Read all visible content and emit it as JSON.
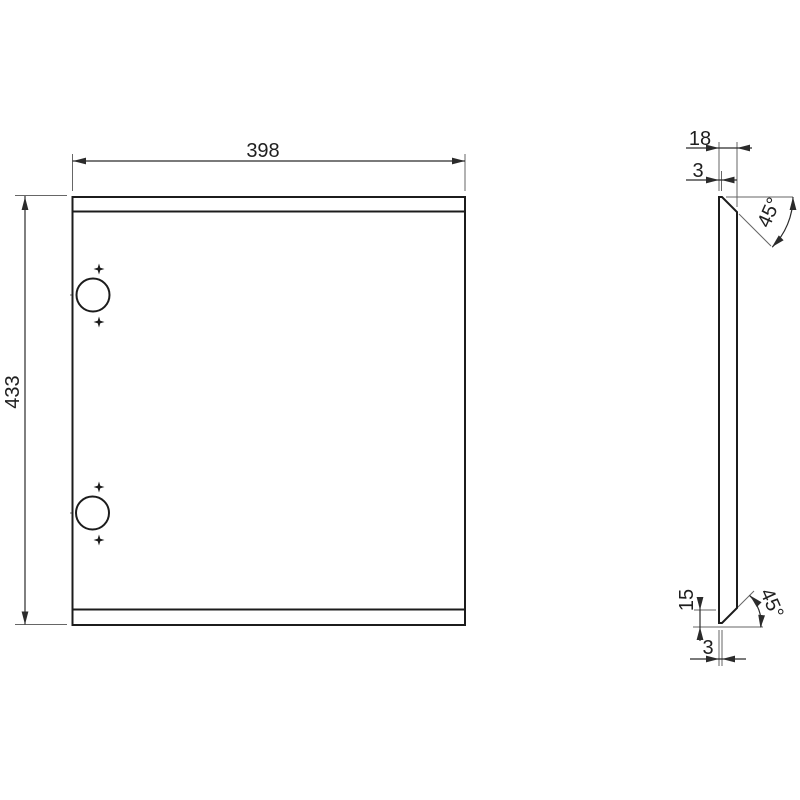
{
  "drawing": {
    "title": "panel-technical-drawing",
    "views": {
      "front": {
        "name": "front-view",
        "width_label": "398",
        "height_label": "433",
        "hole_count": 2
      },
      "side": {
        "name": "side-view",
        "depth_label": "18",
        "top_tip_thickness_label": "3",
        "top_chamfer_angle_label": "45°",
        "bottom_chamfer_height_label": "15",
        "bottom_tip_thickness_label": "3",
        "bottom_chamfer_angle_label": "45°"
      }
    }
  },
  "colors": {
    "background": "#ffffff",
    "object_line": "#1c1c1c",
    "dimension_line": "#2b2b2b",
    "extension_line": "#666666",
    "text": "#1f1f1f"
  },
  "labels": [
    {
      "name": "dim-label-width",
      "text": "398",
      "x": 263,
      "y": 157,
      "rot": 0
    },
    {
      "name": "dim-label-height",
      "text": "433",
      "x": 19,
      "y": 392,
      "rot": -90
    },
    {
      "name": "dim-label-depth",
      "text": "18",
      "x": 700,
      "y": 145,
      "rot": 0
    },
    {
      "name": "dim-label-top-thickness",
      "text": "3",
      "x": 698,
      "y": 177,
      "rot": 0
    },
    {
      "name": "dim-label-top-angle",
      "text": "45°",
      "x": 775,
      "y": 215,
      "rot": -66
    },
    {
      "name": "dim-label-chamfer-height",
      "text": "15",
      "x": 693,
      "y": 600,
      "rot": -90
    },
    {
      "name": "dim-label-bottom-angle",
      "text": "45°",
      "x": 766,
      "y": 606,
      "rot": 66
    },
    {
      "name": "dim-label-bottom-thickness",
      "text": "3",
      "x": 708,
      "y": 654,
      "rot": 0
    }
  ],
  "geom": {
    "object_paths": [
      {
        "name": "panel-outline",
        "d": "M72.5,197 H465 V625 H72.5 Z",
        "fill": true
      },
      {
        "name": "panel-top-fold-line",
        "d": "M72.5,211.5 H465"
      },
      {
        "name": "panel-bottom-fold-line",
        "d": "M72.5,609.5 H465"
      },
      {
        "name": "side-profile-outline",
        "d": "M719,197 L722,197 L737,212 L737,608 L722,623 L719,623 Z",
        "fill": true
      }
    ],
    "circles": [
      {
        "name": "hinge-cup-hole-top",
        "cx": 93,
        "cy": 295,
        "r": 16.5
      },
      {
        "name": "hinge-cup-hole-bottom",
        "cx": 92.5,
        "cy": 513,
        "r": 16.5
      }
    ],
    "center_lines": [
      {
        "name": "hole-top-centerline-h",
        "x1": 70,
        "y1": 295,
        "x2": 116,
        "y2": 295
      },
      {
        "name": "hole-top-centerline-v",
        "x1": 93,
        "y1": 273,
        "x2": 93,
        "y2": 317
      },
      {
        "name": "hole-bottom-centerline-h",
        "x1": 70,
        "y1": 513,
        "x2": 116,
        "y2": 513
      },
      {
        "name": "hole-bottom-centerline-v",
        "x1": 92.5,
        "y1": 491,
        "x2": 92.5,
        "y2": 535
      }
    ],
    "stars": [
      {
        "name": "screw-pilot-mark",
        "x": 99,
        "y": 269
      },
      {
        "name": "screw-pilot-mark",
        "x": 99,
        "y": 322
      },
      {
        "name": "screw-pilot-mark",
        "x": 99,
        "y": 487
      },
      {
        "name": "screw-pilot-mark",
        "x": 99,
        "y": 540
      }
    ],
    "extension_lines": [
      {
        "name": "ext-height-top",
        "x1": 15,
        "y1": 195.5,
        "x2": 67,
        "y2": 195.5
      },
      {
        "name": "ext-height-bottom",
        "x1": 15,
        "y1": 624.5,
        "x2": 67,
        "y2": 624.5
      },
      {
        "name": "ext-width-left",
        "x1": 72.5,
        "y1": 154,
        "x2": 72.5,
        "y2": 191
      },
      {
        "name": "ext-width-right",
        "x1": 465,
        "y1": 154,
        "x2": 465,
        "y2": 191
      },
      {
        "name": "ext-depth-left",
        "x1": 719,
        "y1": 142,
        "x2": 719,
        "y2": 191
      },
      {
        "name": "ext-depth-right",
        "x1": 737,
        "y1": 142,
        "x2": 737,
        "y2": 207
      },
      {
        "name": "ext-top-thickness",
        "x1": 721.5,
        "y1": 171,
        "x2": 721.5,
        "y2": 191
      },
      {
        "name": "ext-top-angle-horizontal",
        "x1": 726,
        "y1": 197,
        "x2": 793,
        "y2": 197
      },
      {
        "name": "ext-top-chamfer",
        "x1": 739,
        "y1": 214,
        "x2": 771,
        "y2": 246
      },
      {
        "name": "ext-chamfer-top",
        "x1": 694,
        "y1": 610,
        "x2": 716,
        "y2": 610
      },
      {
        "name": "ext-bottom-horizontal",
        "x1": 693,
        "y1": 627,
        "x2": 763,
        "y2": 627
      },
      {
        "name": "ext-bottom-chamfer",
        "x1": 726,
        "y1": 619,
        "x2": 754,
        "y2": 591
      },
      {
        "name": "ext-bottom-thickness-left",
        "x1": 719,
        "y1": 630,
        "x2": 719,
        "y2": 666
      },
      {
        "name": "ext-bottom-thickness-right",
        "x1": 722,
        "y1": 630,
        "x2": 722,
        "y2": 666
      }
    ],
    "dimension_lines": [
      {
        "name": "dimline-width",
        "x1": 72.5,
        "y1": 161,
        "x2": 465,
        "y2": 161
      },
      {
        "name": "dimline-height",
        "x1": 25,
        "y1": 196,
        "x2": 25,
        "y2": 624.5
      },
      {
        "name": "dimline-depth",
        "x1": 686,
        "y1": 148,
        "x2": 752,
        "y2": 148
      },
      {
        "name": "dimline-top-thickness",
        "x1": 686,
        "y1": 180,
        "x2": 737,
        "y2": 180
      },
      {
        "name": "dimline-chamfer-height",
        "x1": 700,
        "y1": 597,
        "x2": 700,
        "y2": 641
      },
      {
        "name": "dimline-bottom-thickness",
        "x1": 690,
        "y1": 659,
        "x2": 746,
        "y2": 659
      }
    ],
    "arcs": [
      {
        "name": "arc-top-angle",
        "d": "M793,197 A71,71 0 0 1 772.2,247.2"
      },
      {
        "name": "arc-bottom-angle",
        "d": "M761,627 A39,39 0 0 0 749.6,595.4"
      }
    ],
    "arrows": [
      {
        "name": "arrowhead",
        "x": 73,
        "y": 161,
        "a": 180
      },
      {
        "name": "arrowhead",
        "x": 465,
        "y": 161,
        "a": 0
      },
      {
        "name": "arrowhead",
        "x": 25,
        "y": 197,
        "a": -90
      },
      {
        "name": "arrowhead",
        "x": 25,
        "y": 624.5,
        "a": 90
      },
      {
        "name": "arrowhead",
        "x": 719,
        "y": 148,
        "a": 0
      },
      {
        "name": "arrowhead",
        "x": 737,
        "y": 148,
        "a": 180
      },
      {
        "name": "arrowhead",
        "x": 719,
        "y": 180,
        "a": 0
      },
      {
        "name": "arrowhead",
        "x": 721.5,
        "y": 180,
        "a": 180
      },
      {
        "name": "arrowhead",
        "x": 700,
        "y": 610,
        "a": 90
      },
      {
        "name": "arrowhead",
        "x": 700,
        "y": 627,
        "a": -90
      },
      {
        "name": "arrowhead",
        "x": 719,
        "y": 659,
        "a": 0
      },
      {
        "name": "arrowhead",
        "x": 722,
        "y": 659,
        "a": 180
      },
      {
        "name": "arrowhead",
        "x": 793,
        "y": 197,
        "a": -90
      },
      {
        "name": "arrowhead",
        "x": 772,
        "y": 247,
        "a": 135
      },
      {
        "name": "arrowhead",
        "x": 760.5,
        "y": 628,
        "a": 95
      },
      {
        "name": "arrowhead",
        "x": 750,
        "y": 595.5,
        "a": -135
      }
    ]
  }
}
